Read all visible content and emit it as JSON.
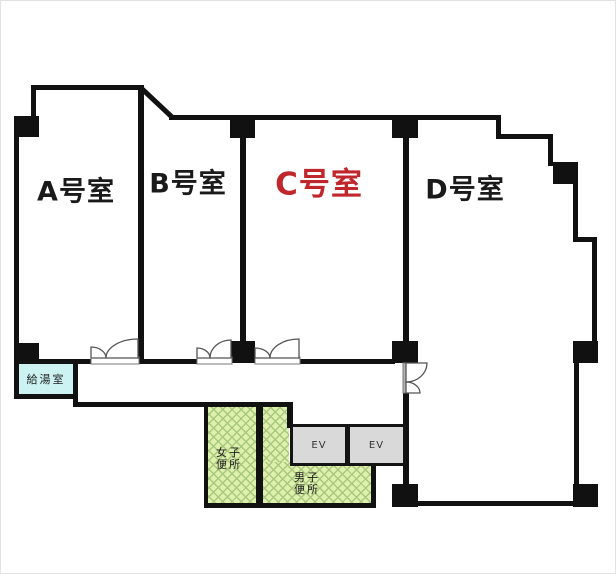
{
  "rooms": {
    "a": {
      "label": "A号室"
    },
    "b": {
      "label": "B号室"
    },
    "c": {
      "label": "C号室"
    },
    "d": {
      "label": "D号室"
    }
  },
  "facilities": {
    "kitchen": {
      "label": "給湯室"
    },
    "womens_toilet": {
      "line1": "女子",
      "line2": "便所"
    },
    "mens_toilet": {
      "line1": "男子",
      "line2": "便所"
    },
    "elevator1": {
      "label": "EV"
    },
    "elevator2": {
      "label": "EV"
    }
  },
  "colors": {
    "wall": "#111111",
    "room_c_text": "#c0272d",
    "room_text": "#1a1a1a",
    "kitchen_fill": "#ccf2f2",
    "toilet_fill": "#def0ae",
    "toilet_hatch": "#a9c87d",
    "elevator_fill": "#d9d9d9",
    "background": "#ffffff"
  }
}
